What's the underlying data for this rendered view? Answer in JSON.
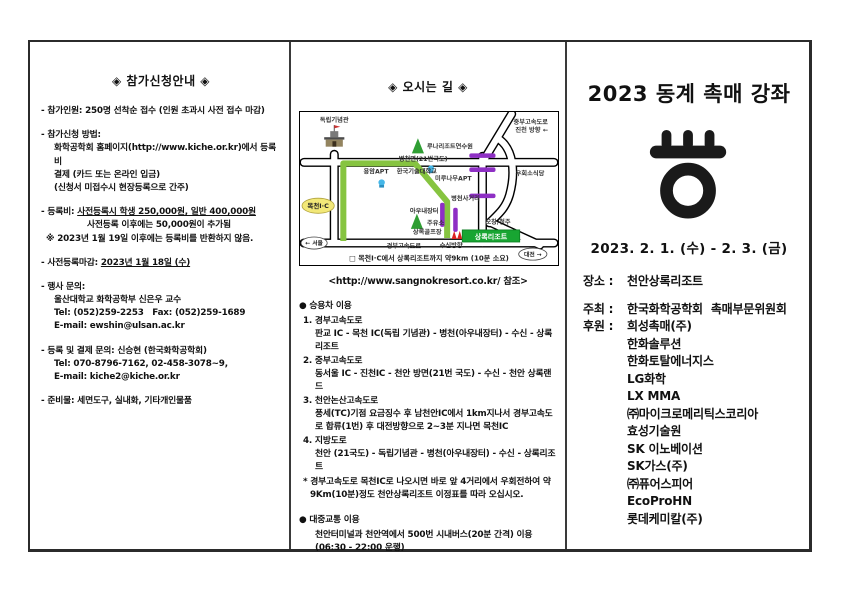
{
  "colors": {
    "route_green": "#86c440",
    "arrow_purple": "#8e2fc4",
    "ic_yellow": "#f2e878",
    "resort_green": "#18a532"
  },
  "left": {
    "title": "◈ 참가신청안내 ◈",
    "item1": "- 참가인원: 250명 선착순 접수 (인원 초과시 사전 접수 마감)",
    "item2_head": "- 참가신청 방법:",
    "item2_line1": "화학공학회 홈페이지(http://www.kiche.or.kr)에서 등록비",
    "item2_line2": "결제 (카드 또는 온라인 입금)",
    "item2_line3": "(신청서 미접수시 현장등록으로 간주)",
    "item3_prefix": "- 등록비: ",
    "item3_underline": "사전등록시 학생 250,000원, 일반 400,000원",
    "item3_line2": "사전등록 이후에는 50,000원이 추가됨",
    "item3_line3": "※ 2023년 1월 19일 이후에는 등록비를 반환하지 않음.",
    "item4_prefix": "- 사전등록마감: ",
    "item4_underline": "2023년 1월 18일 (수)",
    "item5_head": "- 행사 문의:",
    "item5_line1": "울산대학교 화학공학부 신은우 교수",
    "item5_line2": "Tel: (052)259-2253   Fax: (052)259-1689",
    "item5_line3": "E-mail: ewshin@ulsan.ac.kr",
    "item6_head": "- 등록 및 결제 문의: 신승현 (한국화학공학회)",
    "item6_line1": "Tel: 070-8796-7162, 02-458-3078~9,",
    "item6_line2": "E-mail: kiche2@kiche.or.kr",
    "item7": "- 준비물: 세면도구, 실내화, 기타개인물품"
  },
  "mid": {
    "title": "◈ 오시는 길 ◈",
    "map": {
      "caption": "□ 목천I·C에서 상록리조트까지 약9km (10분 소요)",
      "reference": "<http://www.sangnokresort.co.kr/ 참조>",
      "labels": {
        "independence_hall": "독립기념관",
        "luna_center": "루나리조트연수원",
        "jungbu_expwy_1": "중부고속도로",
        "jungbu_expwy_2": "진천 방향 ←",
        "yongam_apt": "용암APT",
        "korea_tech_univ": "한국기술대학교",
        "byeongcheon_rd": "병천면(21번국도)",
        "miruna_apt": "미루나무APT",
        "restaurant": "우회소식당",
        "mokcheon_ic": "목천I·C",
        "byeongcheon_x": "병천사거리",
        "aunae_market": "아우내장터",
        "gas_station": "주유소",
        "sangnok_golf": "상록골프장",
        "ochang_cheongju": "오창/청주",
        "sangnok_resort": "상록리조트",
        "susin_dir": "수신방향",
        "seoul": "← 서울",
        "gyeongbu_expwy": "경부고속도로",
        "daejeon": "대전 →"
      }
    },
    "car_header": "● 승용차 이용",
    "route1_head": "1. 경부고속도로",
    "route1_body": "판교 IC - 목천 IC(독립 기념관) - 병천(아우내장터) - 수신 - 상록리조트",
    "route2_head": "2. 중부고속도로",
    "route2_body": "동서울 IC - 진천IC - 천안 방면(21번 국도) - 수신 - 천안 상록랜드",
    "route3_head": "3. 천안논산고속도로",
    "route3_body": "풍세(TC)기점 요금징수 후 남천안IC에서 1km지나서 경부고속도로 합류(1번) 후 대전방향으로 2~3분 지나면 목천IC",
    "route4_head": "4. 지방도로",
    "route4_body": "천안 (21국도) - 독립기념관 - 병천(아우내장터) - 수신 - 상록리조트",
    "note": "* 경부고속도로 목천IC로 나오시면 바로 앞 4거리에서 우회전하여 약 9Km(10분)정도 천안상록리조트 이정표를 따라 오십시오.",
    "transit_header": "● 대중교통 이용",
    "transit_body": "천안터미널과 천안역에서 500번 시내버스(20분 간격) 이용 (06:30 - 22:00 운행)"
  },
  "right": {
    "title": "2023 동계 촉매 강좌",
    "logo_icon": "catalysis-hieut-logo",
    "date": "2023. 2. 1. (수) - 2. 3. (금)",
    "venue_label": "장소 :",
    "venue": "천안상록리조트",
    "host_label": "주최 :",
    "host": "한국화학공학회  촉매부문위원회",
    "sponsor_label": "후원 :",
    "sponsors": [
      "희성촉매(주)",
      "한화솔루션",
      "한화토탈에너지스",
      "LG화학",
      "LX MMA",
      "㈜마이크로메리틱스코리아",
      "효성기술원",
      "SK 이노베이션",
      "SK가스(주)",
      "㈜퓨어스피어",
      "EcoProHN",
      "롯데케미칼(주)"
    ]
  }
}
